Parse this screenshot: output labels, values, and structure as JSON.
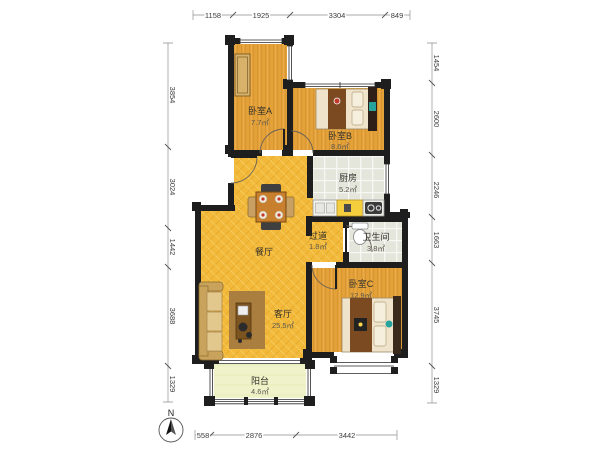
{
  "plan": {
    "type": "apartment-floor-plan",
    "compass": {
      "label": "N"
    },
    "rooms": [
      {
        "id": "bedroom-a",
        "name": "卧室A",
        "area": "7.7㎡"
      },
      {
        "id": "bedroom-b",
        "name": "卧室B",
        "area": "8.6㎡"
      },
      {
        "id": "kitchen",
        "name": "厨房",
        "area": "5.2㎡"
      },
      {
        "id": "hallway",
        "name": "过道",
        "area": "1.8㎡"
      },
      {
        "id": "bathroom",
        "name": "卫生间",
        "area": "3.8㎡"
      },
      {
        "id": "bedroom-c",
        "name": "卧室C",
        "area": "12.9㎡"
      },
      {
        "id": "dining",
        "name": "餐厅",
        "area": ""
      },
      {
        "id": "living",
        "name": "客厅",
        "area": "25.5㎡"
      },
      {
        "id": "balcony",
        "name": "阳台",
        "area": "4.6㎡"
      }
    ],
    "dimensions_mm": {
      "top": [
        "1158",
        "1925",
        "3304",
        "849"
      ],
      "left": [
        "3854",
        "3024",
        "1442",
        "3688",
        "1329"
      ],
      "right": [
        "1454",
        "2600",
        "2246",
        "1663",
        "3745",
        "1329"
      ],
      "bottom": [
        "558",
        "2876",
        "3442"
      ]
    },
    "colors": {
      "wall": "#1E1E1E",
      "wood_floor": "#E5A139",
      "parquet_floor": "#F2B93B",
      "tile_floor": "#E4E6DC",
      "balcony_floor": "#F0F3C9"
    }
  }
}
